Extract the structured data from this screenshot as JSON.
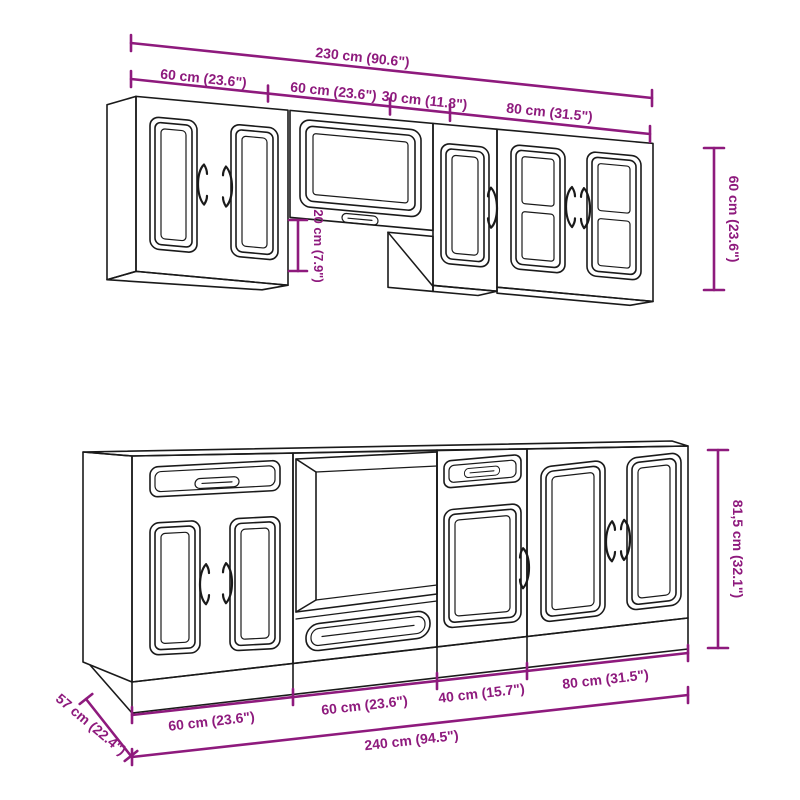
{
  "diagram_type": "kitchen cabinet set dimension drawing",
  "colors": {
    "dimension_accent": "#8E1A7D",
    "drawing_ink": "#1A1A1A",
    "background": "#FFFFFF"
  },
  "upper_row": {
    "total_width": "230 cm (90.6\")",
    "segment_widths": [
      "60 cm (23.6\")",
      "60 cm (23.6\")",
      "30 cm (11.8\")",
      "80 cm (31.5\")"
    ],
    "cabinet_height": "60 cm (23.6\")",
    "underside_offset": "20 cm (7.9\")"
  },
  "lower_row": {
    "total_width": "240 cm (94.5\")",
    "segment_widths": [
      "60 cm (23.6\")",
      "60 cm (23.6\")",
      "40 cm (15.7\")",
      "80 cm (31.5\")"
    ],
    "cabinet_height": "81,5 cm (32.1\")",
    "cabinet_depth": "57 cm (22.4\")"
  }
}
